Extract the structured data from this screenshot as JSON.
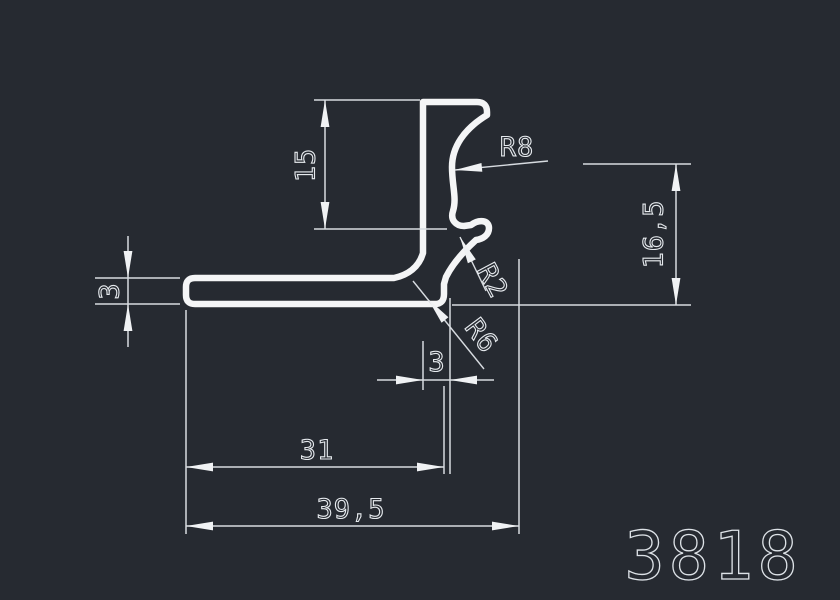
{
  "drawing": {
    "part_number": "3818",
    "profile_type": "extrusion-cross-section",
    "dimensions": {
      "upper_height": "15",
      "radius_large": "R8",
      "right_height": "16,5",
      "left_thickness": "3",
      "radius_small": "R2",
      "radius_fillet": "R6",
      "bottom_thickness": "3",
      "inner_width": "31",
      "total_width": "39,5"
    },
    "colors": {
      "background": "#262a31",
      "profile_line": "#f4f5f6",
      "dimension_line": "#d7dbe0",
      "text": "#e6eaee"
    }
  }
}
